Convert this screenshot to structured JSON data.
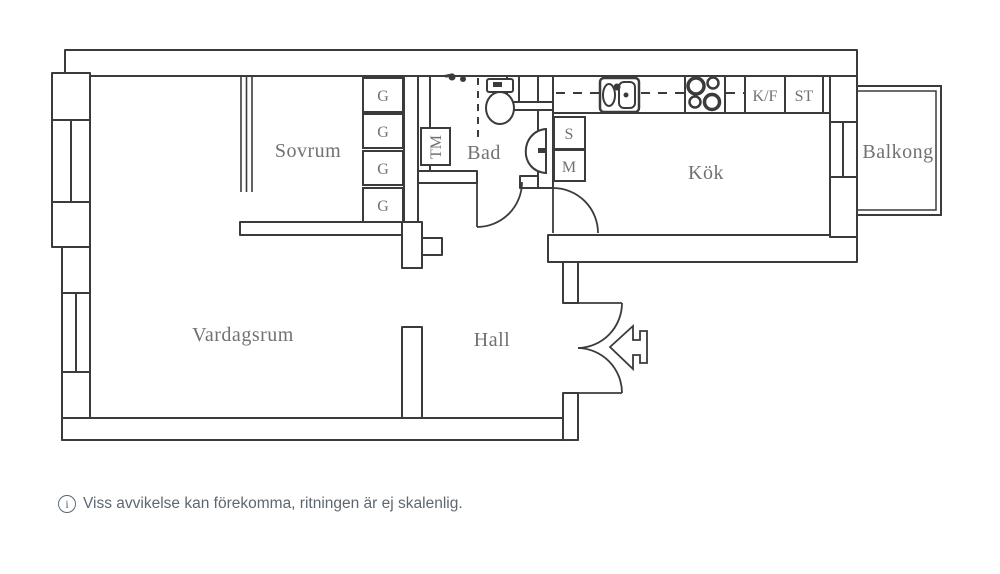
{
  "plan": {
    "rooms": {
      "sovrum": "Sovrum",
      "bad": "Bad",
      "kok": "Kök",
      "balkong": "Balkong",
      "vardagsrum": "Vardagsrum",
      "hall": "Hall"
    },
    "fixtures": {
      "garderob": "G",
      "tvattmaskin": "TM",
      "skap_s": "S",
      "skap_m": "M",
      "kyl_frys": "K/F",
      "stad": "ST"
    },
    "colors": {
      "wall_line": "#3b3b3b",
      "label_text": "#717171",
      "footer_text": "#5c6771",
      "background": "#ffffff"
    }
  },
  "footer": {
    "icon_letter": "i",
    "note": "Viss avvikelse kan förekomma, ritningen är ej skalenlig."
  }
}
